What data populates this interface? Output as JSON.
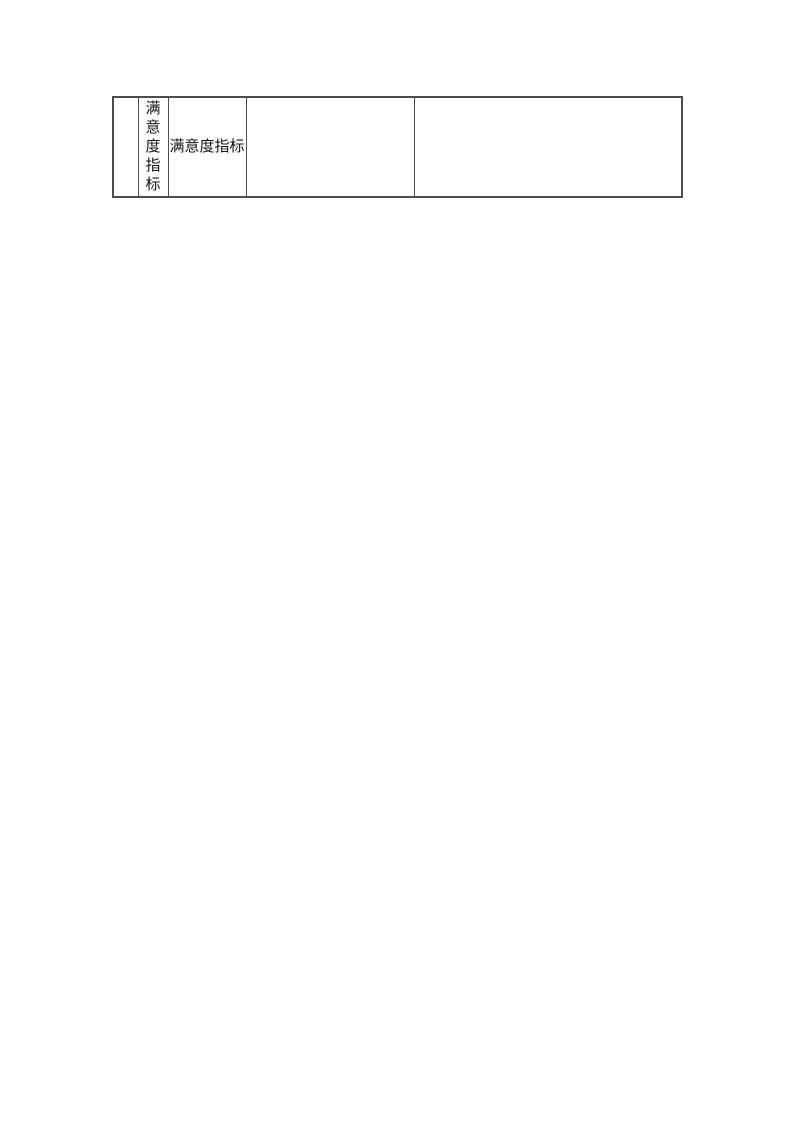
{
  "page": {
    "background_color": "#ffffff",
    "text_color": "#141414",
    "table_border_color": "#4d4d4d"
  },
  "table": {
    "description": "continuation fragment of a table at top of an otherwise blank document page",
    "row": {
      "col1": "",
      "col2": "满意度指标",
      "col3": "满意度指标",
      "col4": "",
      "col5": ""
    },
    "column_widths_px": [
      25,
      30,
      78,
      168,
      268
    ]
  }
}
